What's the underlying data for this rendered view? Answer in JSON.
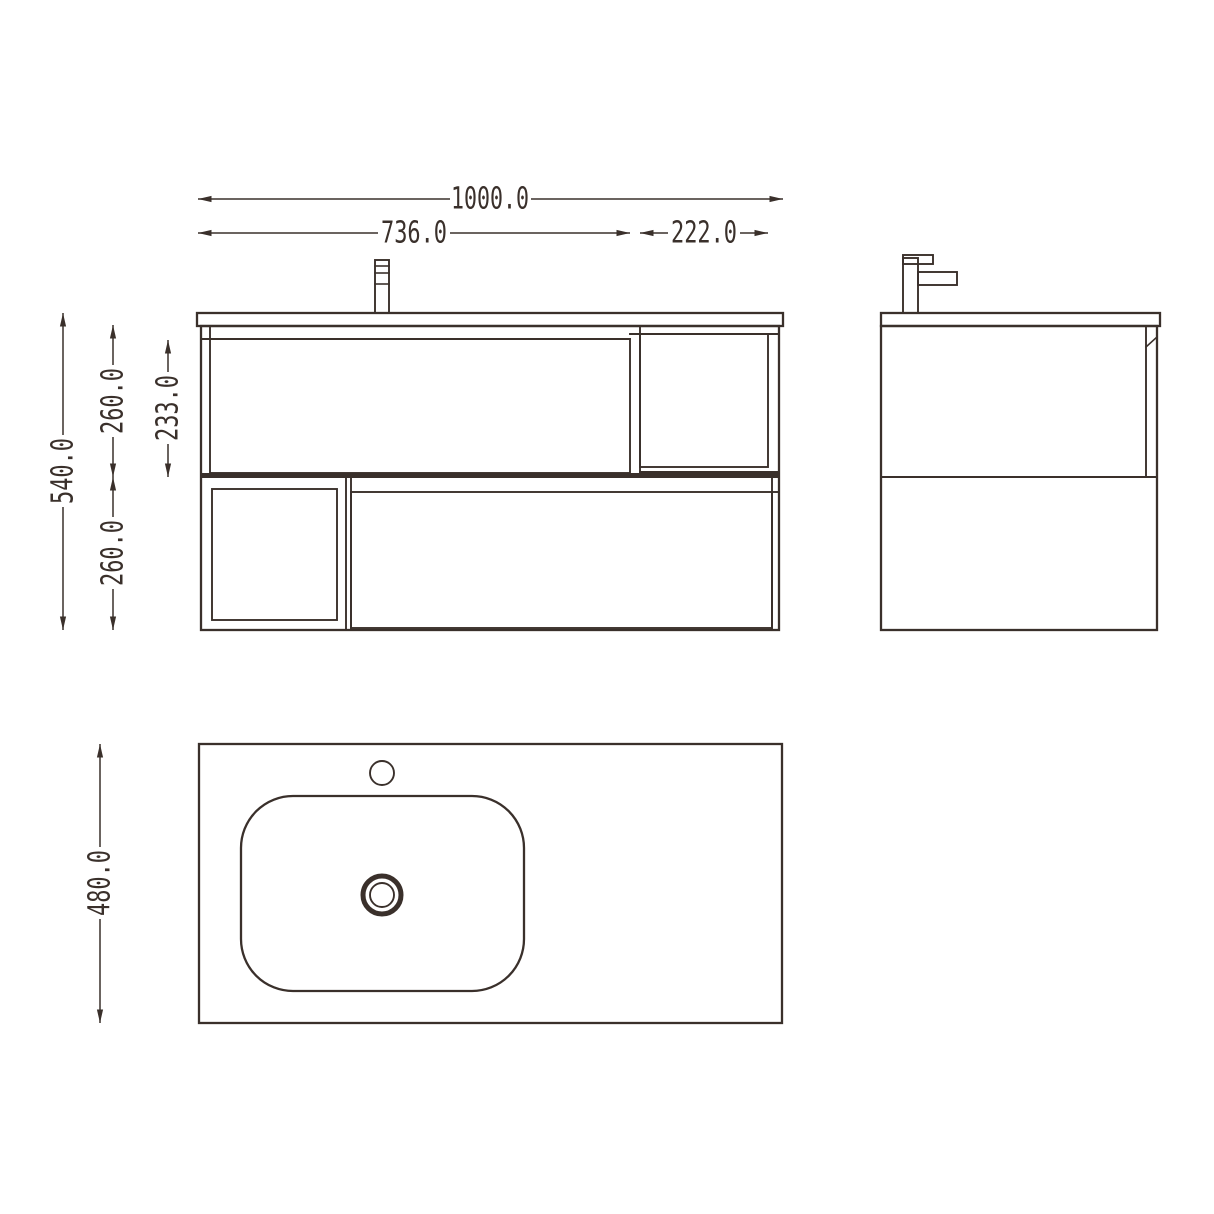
{
  "drawing": {
    "line_color": "#3a302b",
    "background_color": "#ffffff",
    "dims": {
      "total_width": "1000.0",
      "left_section_width": "736.0",
      "right_shelf_width": "222.0",
      "total_height": "540.0",
      "upper_section_height": "260.0",
      "drawer_front_height": "233.0",
      "lower_section_height": "260.0",
      "depth": "480.0"
    }
  }
}
